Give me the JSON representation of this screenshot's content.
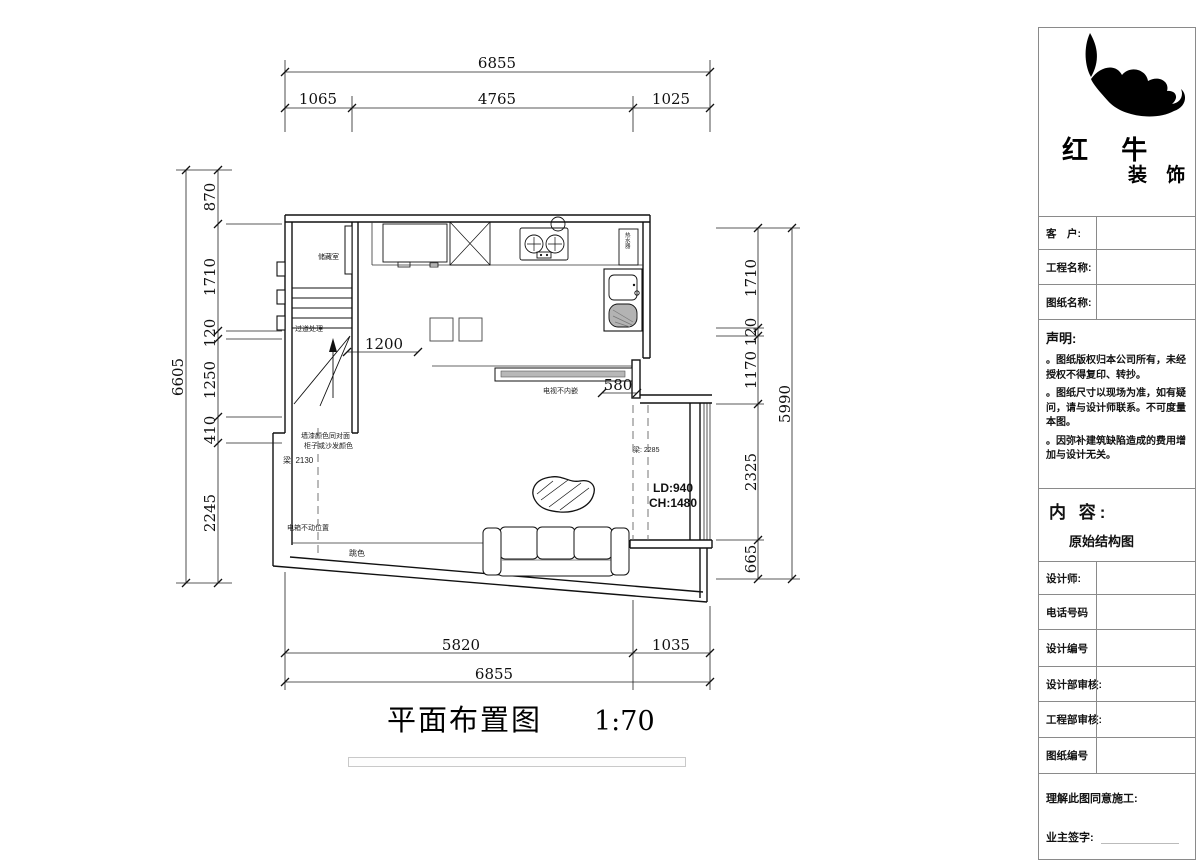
{
  "caption": {
    "title": "平面布置图",
    "scale": "1:70"
  },
  "dims": {
    "top": {
      "total": "6855",
      "s1": "1065",
      "s2": "4765",
      "s3": "1025"
    },
    "bottom": {
      "s1": "5820",
      "s2": "1035",
      "total": "6855"
    },
    "left": {
      "total": "6605",
      "s1": "870",
      "s2": "1710",
      "s3": "120",
      "s4": "1250",
      "s5": "410",
      "s6": "2245"
    },
    "right": {
      "total": "5990",
      "s1": "1710",
      "s2": "120",
      "s3": "1170",
      "s4": "2325",
      "s5": "665"
    },
    "inner": {
      "d1": "1200",
      "d2": "580"
    }
  },
  "plan_labels": {
    "storage": "储藏室",
    "corridor": "过道处理",
    "tv": "电视不内嵌",
    "wall_note1": "墙漆颜色同对面",
    "wall_note2": "柜子或沙发颜色",
    "beam_left": "梁: 2130",
    "beam_right": "梁: 2285",
    "box_note": "电箱不动位置",
    "accent": "跳色",
    "ld": "LD:940",
    "ch": "CH:1480",
    "heater": "热水器"
  },
  "panel": {
    "brand": {
      "name_top": "红 牛",
      "name_bottom": "装 饰"
    },
    "rows": [
      {
        "label": "客　户:"
      },
      {
        "label": "工程名称:"
      },
      {
        "label": "图纸名称:"
      }
    ],
    "statement": {
      "title": "声明:",
      "items": [
        "。图纸版权归本公司所有，未经授权不得复印、转抄。",
        "。图纸尺寸以现场为准，如有疑问，请与设计师联系。不可度量本图。",
        "。因弥补建筑缺陷造成的费用增加与设计无关。"
      ]
    },
    "content": {
      "label": "内 容:",
      "value": "原始结构图"
    },
    "rows2": [
      {
        "label": "设计师:"
      },
      {
        "label": "电话号码"
      },
      {
        "label": "设计编号"
      },
      {
        "label": "设计部审核:"
      },
      {
        "label": "工程部审核:"
      },
      {
        "label": "图纸编号"
      }
    ],
    "sign": {
      "line1": "理解此图同意施工:",
      "line2": "业主签字:"
    }
  }
}
